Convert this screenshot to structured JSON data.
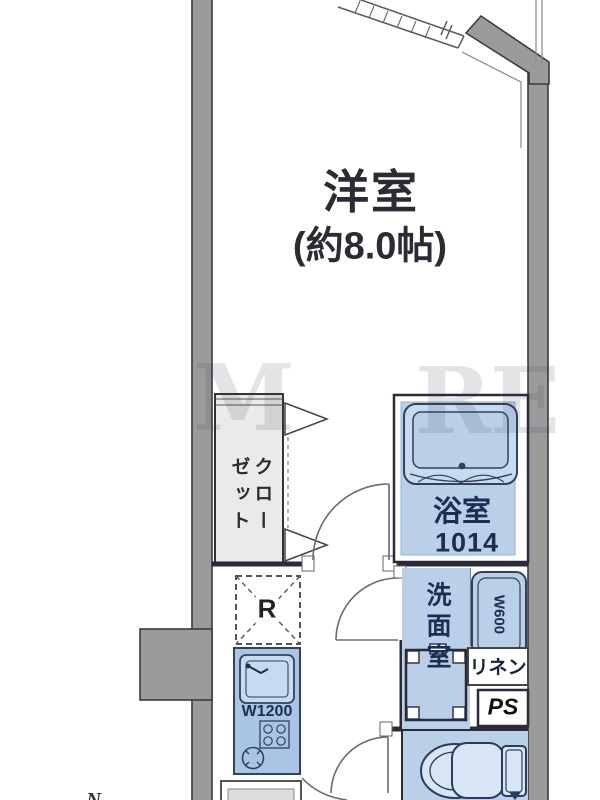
{
  "rooms": {
    "main_room": {
      "name": "洋室",
      "size_label": "(約8.0帖)"
    },
    "closet": {
      "col_right": "クロー",
      "col_left": "ゼット"
    },
    "bathroom": {
      "name": "浴室",
      "size_label": "1014"
    },
    "washroom": {
      "name": "洗面室"
    }
  },
  "fixtures": {
    "washer_pan_label": "W600",
    "linen_label": "リネン",
    "pipe_space_label": "PS",
    "refrigerator_label": "R",
    "kitchen_label": "W1200"
  },
  "watermark": {
    "part1": "M",
    "part2": "R",
    "part3": "E"
  },
  "compass": {
    "north_label": "N"
  },
  "colors": {
    "wall_fill": "#9b9b9b",
    "wall_edge": "#3a3a42",
    "room_fill_blue": "#b9d0e8",
    "fixture_fill_blue": "#a8c6e4",
    "tub_fill": "#c6daf0",
    "label_navy": "#1e2d52",
    "closet_fill": "#eaeaea",
    "text_dark": "#2b2b33",
    "watermark_color": "#3a3a50"
  }
}
